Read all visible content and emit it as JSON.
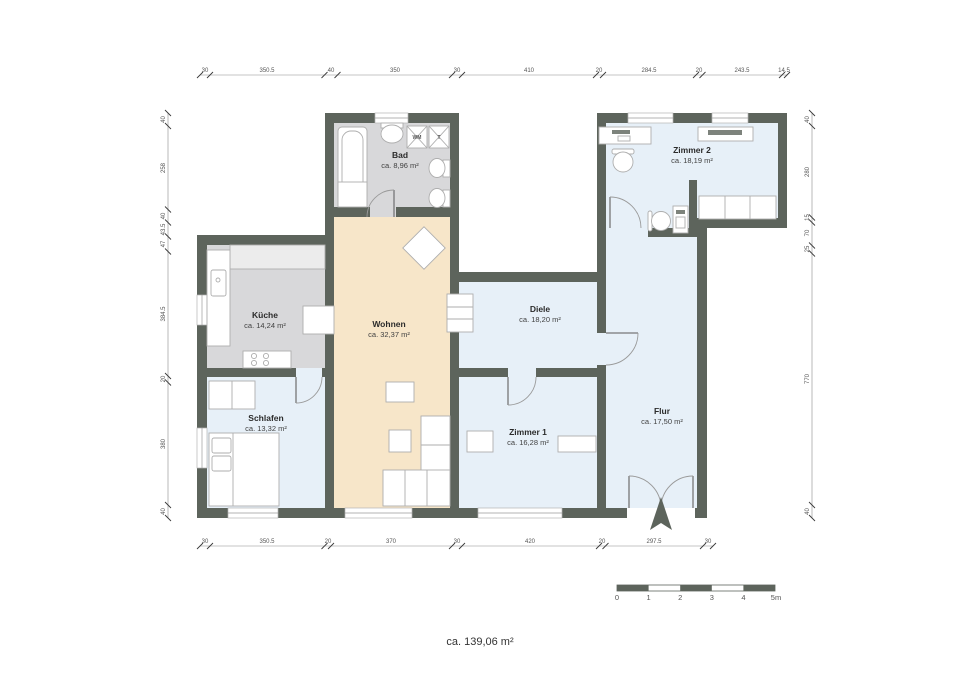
{
  "title": "Grundriss Wohnung",
  "total_area": "ca. 139,06 m²",
  "rooms": {
    "bad": {
      "name": "Bad",
      "area": "ca. 8,96 m²"
    },
    "zimmer2": {
      "name": "Zimmer 2",
      "area": "ca. 18,19 m²"
    },
    "kueche": {
      "name": "Küche",
      "area": "ca. 14,24 m²"
    },
    "wohnen": {
      "name": "Wohnen",
      "area": "ca. 32,37 m²"
    },
    "diele": {
      "name": "Diele",
      "area": "ca. 18,20 m²"
    },
    "schlafen": {
      "name": "Schlafen",
      "area": "ca. 13,32 m²"
    },
    "zimmer1": {
      "name": "Zimmer 1",
      "area": "ca. 16,28 m²"
    },
    "flur": {
      "name": "Flur",
      "area": "ca. 17,50 m²"
    }
  },
  "appliances": {
    "washer": "WM",
    "dryer": "T"
  },
  "dimensions": {
    "top": [
      "30",
      "350.5",
      "40",
      "350",
      "30",
      "410",
      "20",
      "284.5",
      "20",
      "243.5",
      "14.5"
    ],
    "bottom": [
      "30",
      "350.5",
      "20",
      "370",
      "30",
      "420",
      "20",
      "297.5",
      "30"
    ],
    "left": [
      "40",
      "258",
      "40",
      "43.5",
      "47",
      "384.5",
      "20",
      "380",
      "40"
    ],
    "right": [
      "40",
      "280",
      "15",
      "70",
      "25",
      "770",
      "40"
    ]
  },
  "scale_bar": {
    "labels": [
      "0",
      "1",
      "2",
      "3",
      "4",
      "5m"
    ]
  },
  "colors": {
    "wall": "#5d645c",
    "room_blue": "#e7f0f8",
    "room_beige": "#f7e6c9",
    "room_gray": "#d8d8da"
  }
}
